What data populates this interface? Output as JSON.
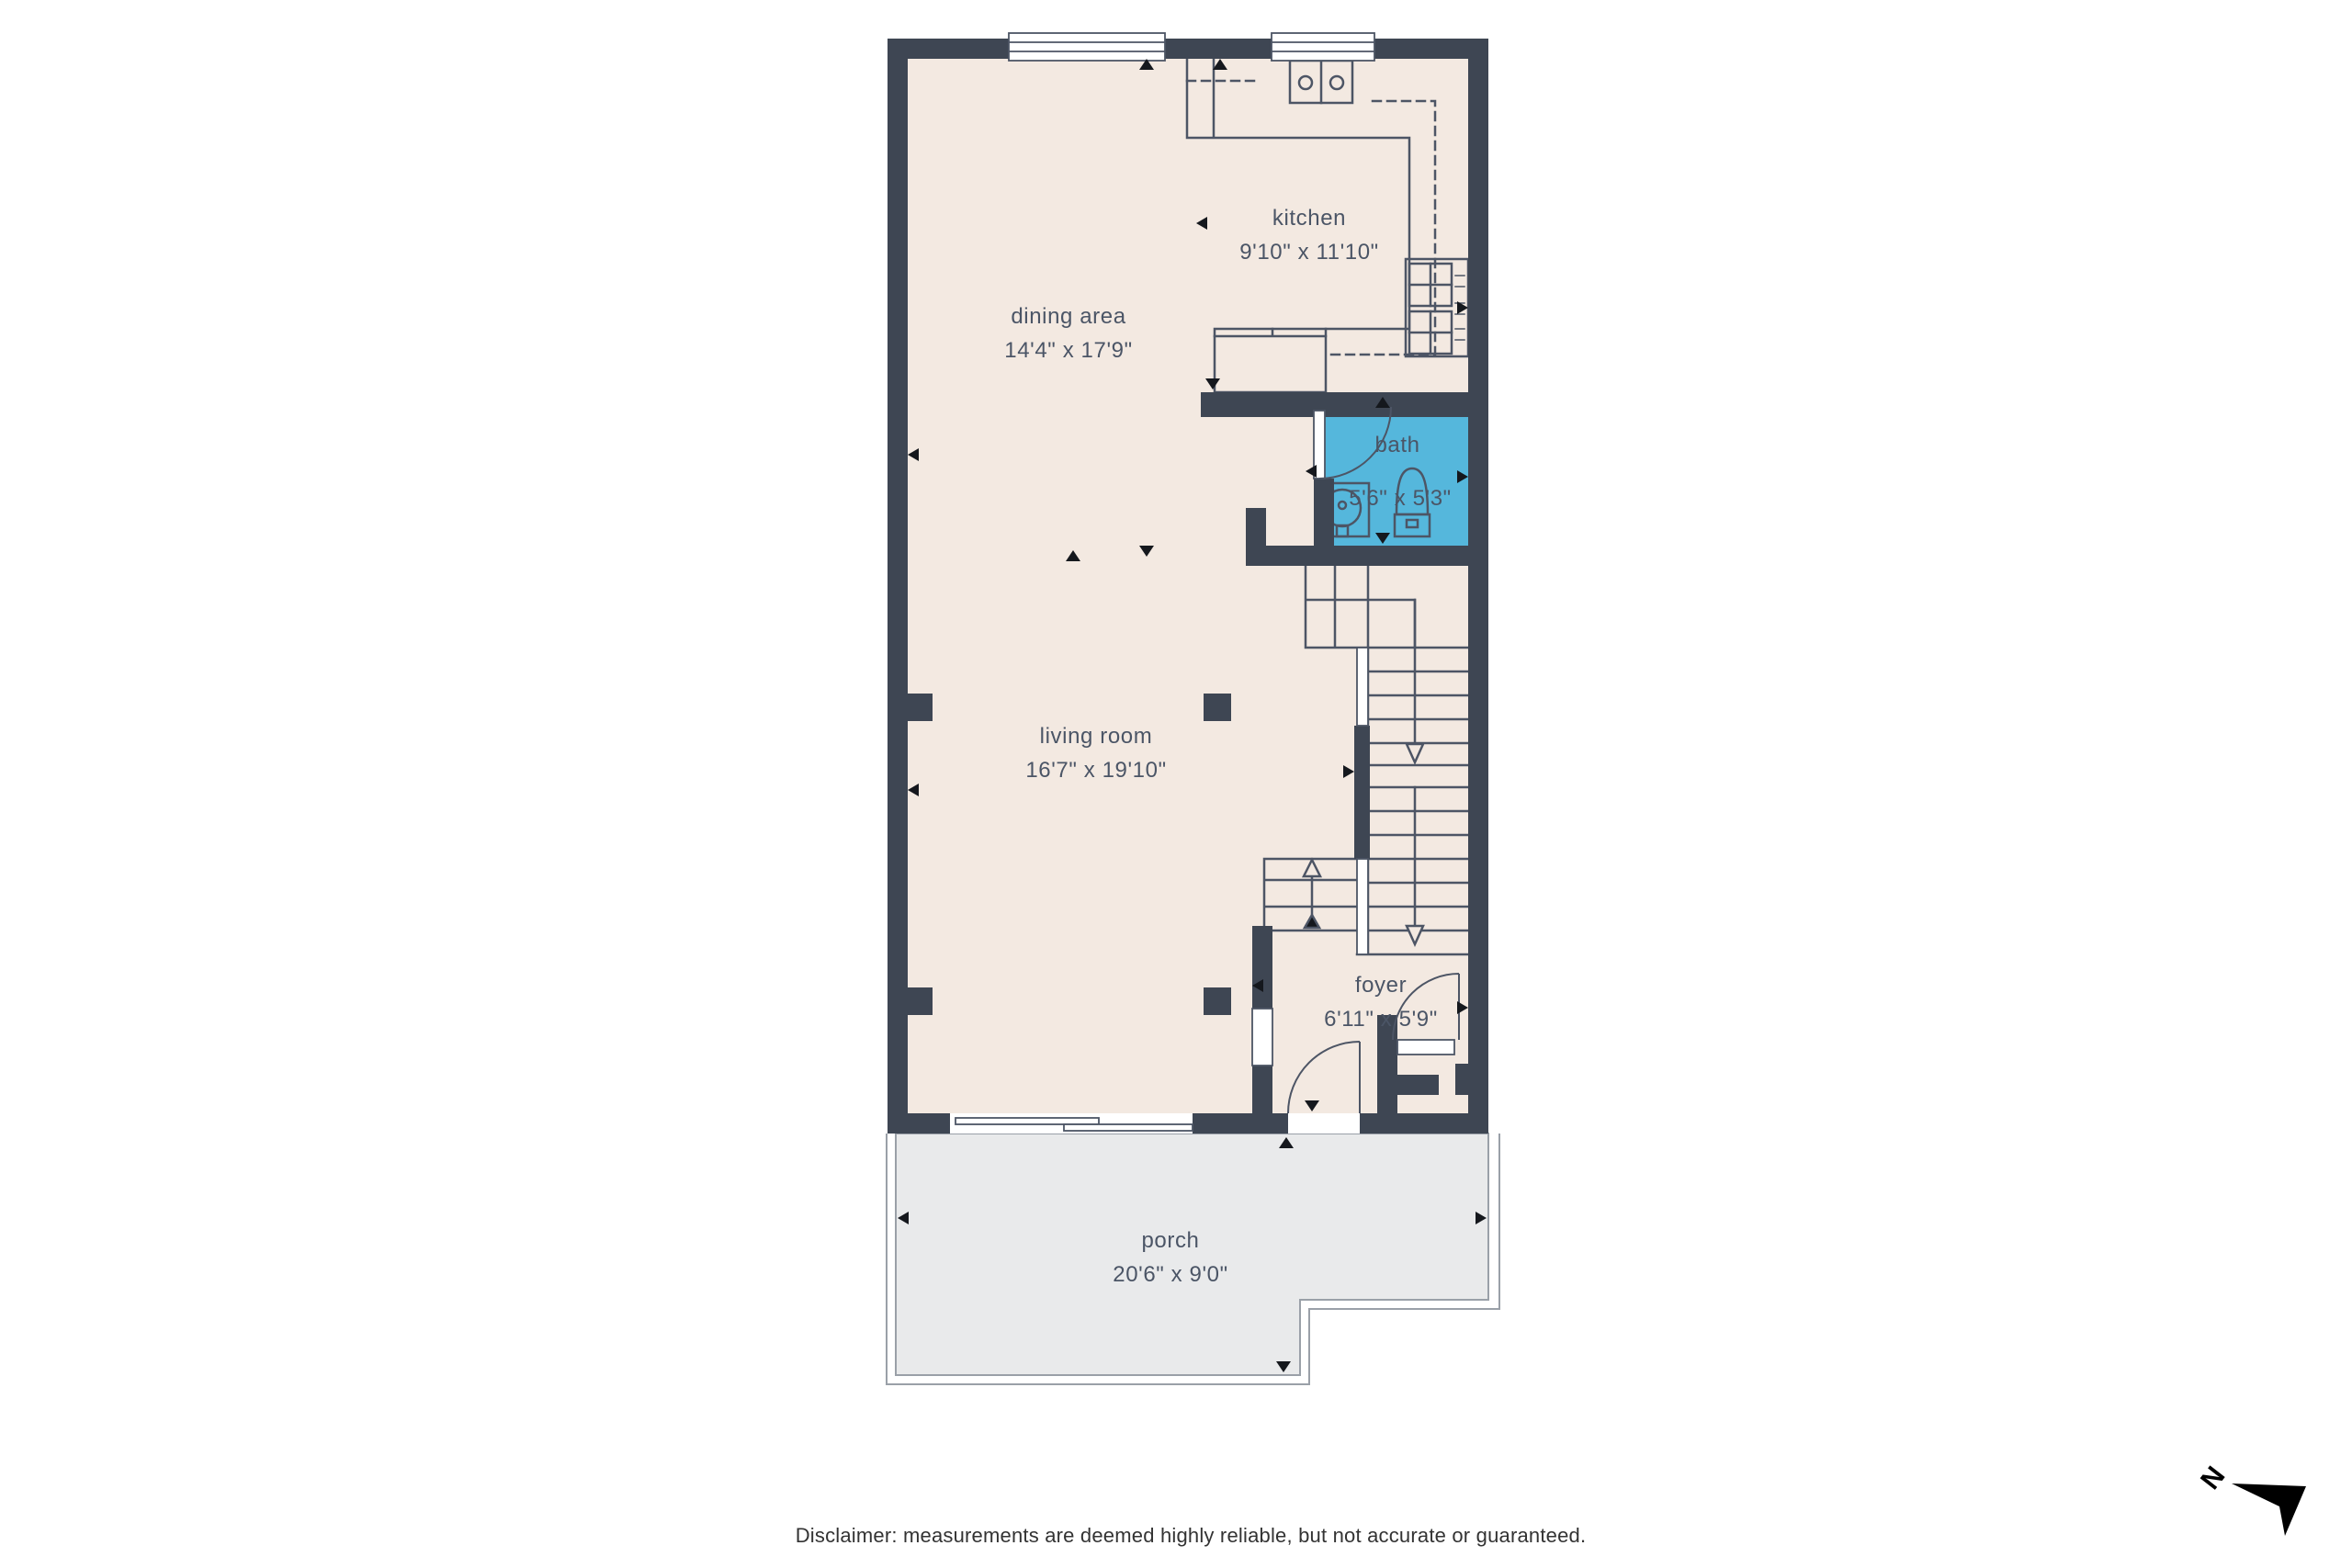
{
  "title": "floor plan",
  "colors": {
    "wall": "#3e4653",
    "floor": "#f3e9e1",
    "bath": "#55b7dc",
    "porch": "#e9eaeb",
    "line": "#4d5565",
    "marker": "#15181d",
    "text": "#4b5566",
    "deck_edge": "#9aa0a8",
    "disclaimer_text": "#333333",
    "compass": "#000000"
  },
  "rooms": [
    {
      "name": "kitchen",
      "dims": "9'10\" x 11'10\""
    },
    {
      "name": "dining area",
      "dims": "14'4\" x 17'9\""
    },
    {
      "name": "bath",
      "dims": "5'6\" x 5'3\""
    },
    {
      "name": "living room",
      "dims": "16'7\" x 19'10\""
    },
    {
      "name": "foyer",
      "dims": "6'11\" x 5'9\""
    },
    {
      "name": "porch",
      "dims": "20'6\" x 9'0\""
    }
  ],
  "disclaimer": "Disclaimer: measurements are deemed highly reliable, but not accurate or guaranteed.",
  "compass": {
    "label": "N"
  }
}
